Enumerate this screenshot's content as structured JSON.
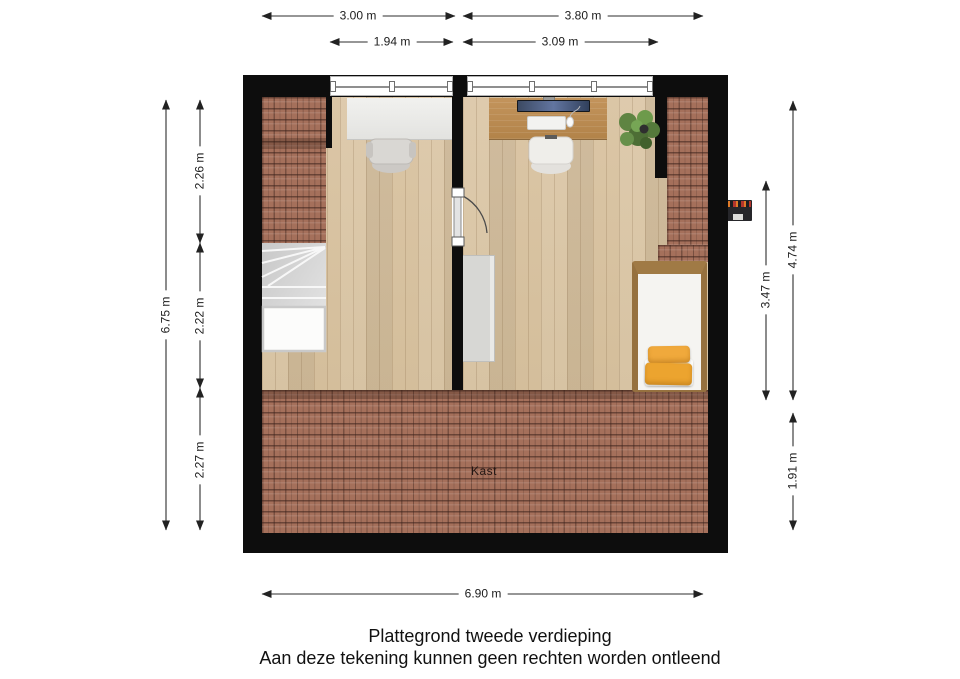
{
  "page": {
    "title": "Plattegrond tweede verdieping",
    "disclaimer": "Aan deze tekening kunnen geen rechten worden ontleend"
  },
  "plan": {
    "kast_label": "Kast",
    "colors": {
      "wall": "#0d0d0d",
      "roof_tiles": "#a5705b",
      "wood_floor": "#d9c4a2",
      "desk_wood": "#bc8d55",
      "desk_white": "#ececea",
      "pillow_yellow": "#f0a93c",
      "plant_green": "#5f8442",
      "stairs_gray": "#d7d7d7"
    }
  },
  "dimensions": {
    "top_room_left": "3.00 m",
    "top_room_right": "3.80 m",
    "top_window_left": "1.94 m",
    "top_window_right": "3.09 m",
    "left_total": "6.75 m",
    "left_top": "2.26 m",
    "left_middle": "2.22 m",
    "left_bottom": "2.27 m",
    "right_total": "4.74 m",
    "right_rooms": "3.47 m",
    "right_kast": "1.91 m",
    "bottom_total": "6.90 m"
  }
}
